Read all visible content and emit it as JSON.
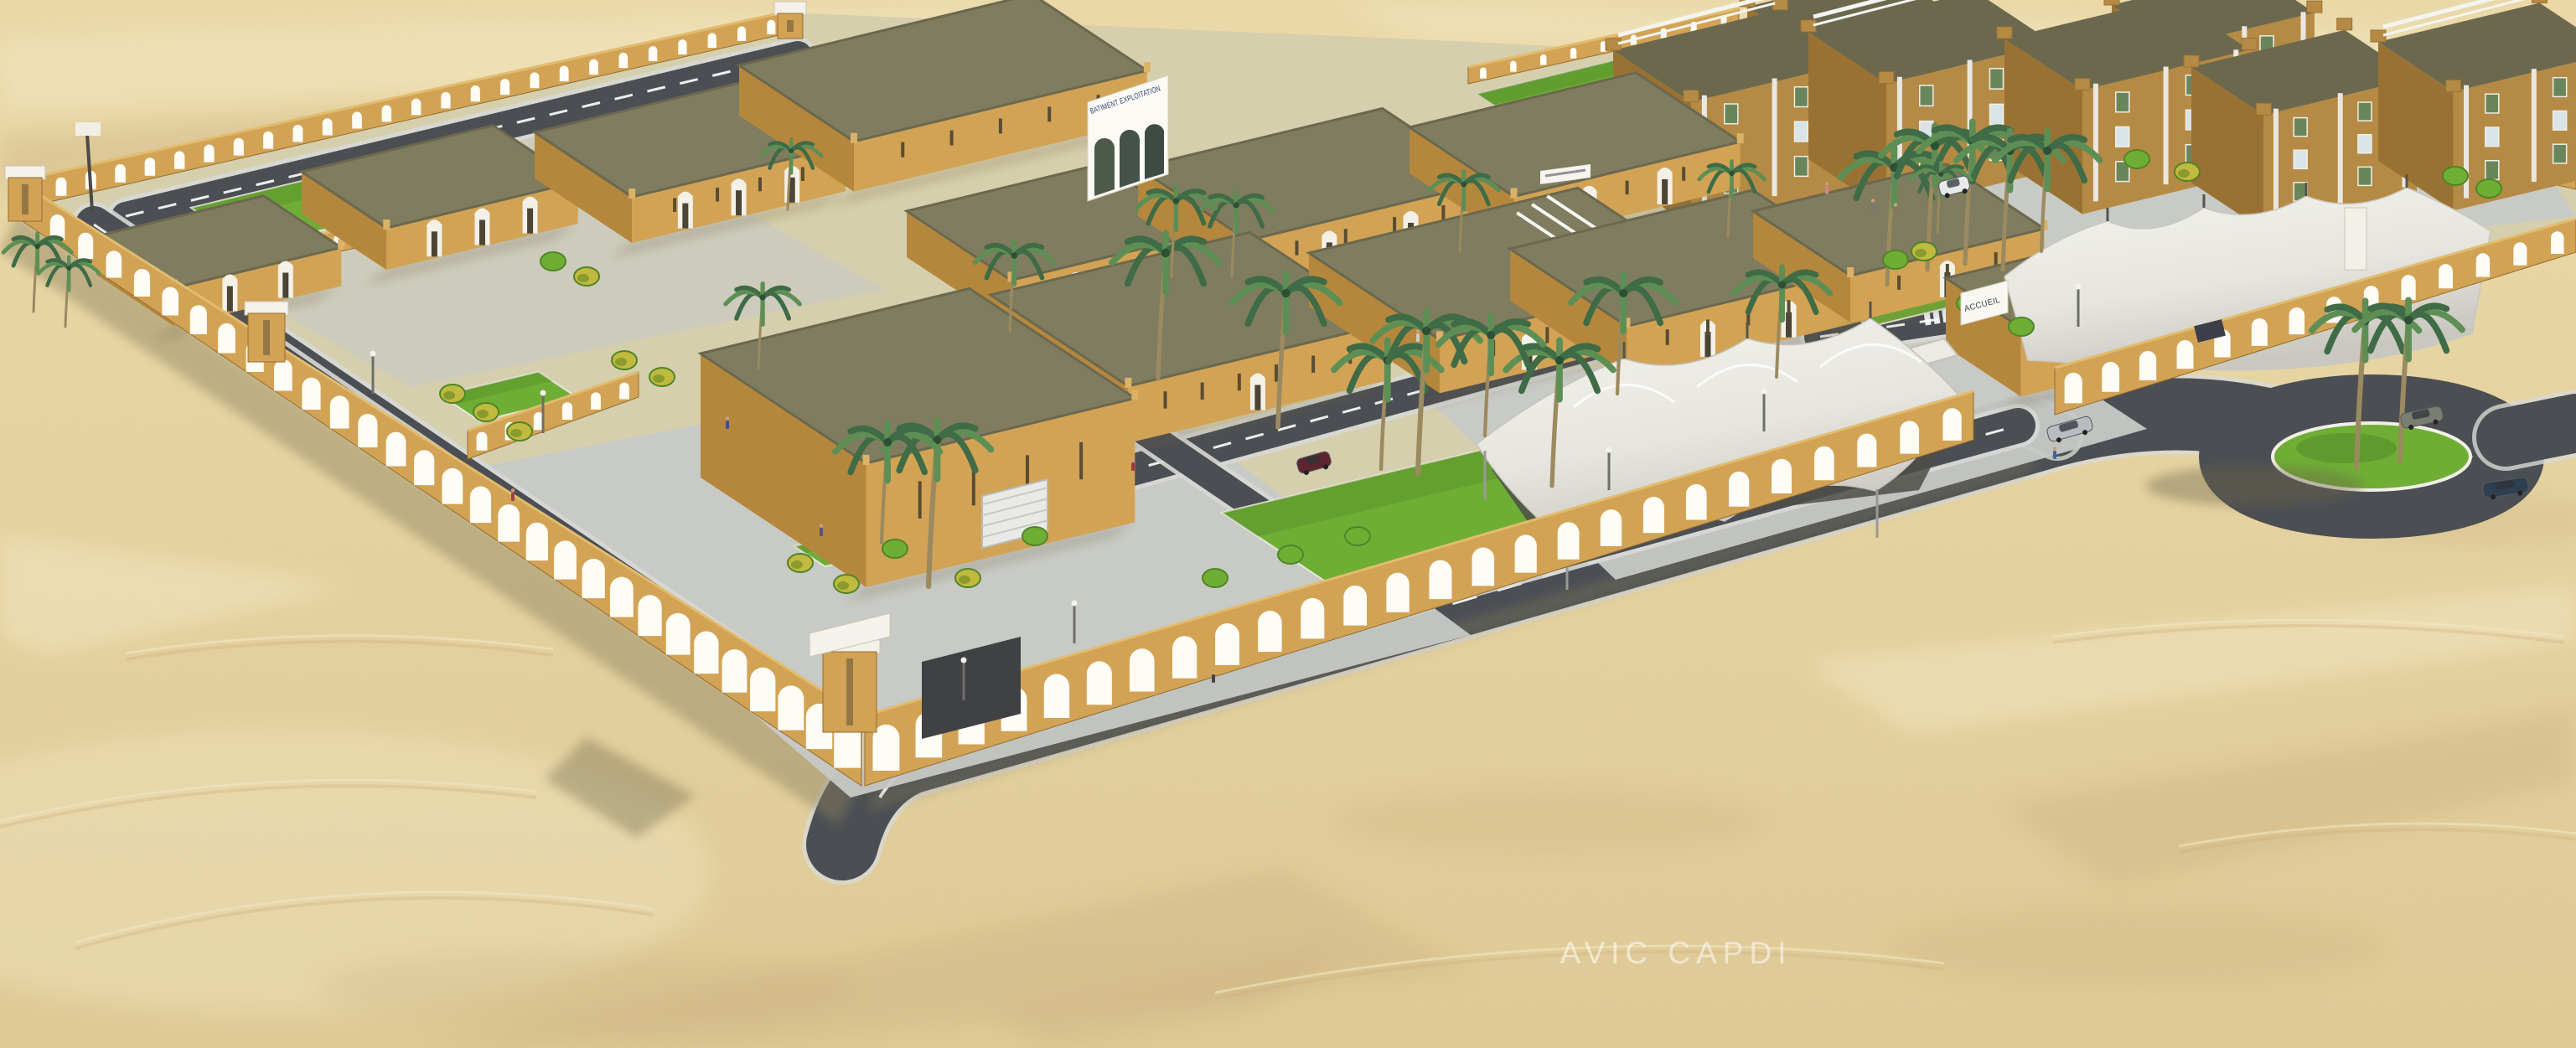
{
  "meta": {
    "alt_text": "Aerial 3D architectural rendering of a walled desert compound: arcaded perimeter walls, flat-roofed sand-colored buildings, multi-storey apartment blocks, palm trees, white tensile shade canopies, internal roads and an exterior roundabout surrounded by open sand dunes."
  },
  "labels": {
    "building_sign": "BATIMENT EXPLOITATION",
    "gate_sign": "ACCUEIL",
    "watermark": "AVIC CAPDI"
  },
  "palette": {
    "sand": "#e7d4a2",
    "sand_light": "#f4e8c3",
    "sand_shadow": "#cdb382",
    "ground": "#d6cfad",
    "paving": "#c7c9c6",
    "paving_light": "#d8d9d6",
    "road": "#4b4e53",
    "road_line": "#ffffff",
    "wall_lit": "#d2a355",
    "wall_shade": "#b5873d",
    "wall_dark": "#966d2e",
    "arch": "#fdfcf5",
    "roof": "#7f7c5f",
    "roof_dark": "#6b684e",
    "grass": "#6fae35",
    "grass_dark": "#4f8527",
    "palm_dark": "#3f6b46",
    "palm_light": "#5d8f55",
    "trunk": "#9b8a60",
    "tent": "#efeee8",
    "tent_shade": "#cfcec7",
    "tent_under": "#4e4d48",
    "white": "#ffffff",
    "sign_text": "#2a3c6e",
    "apt_lit": "#b58a44",
    "apt_shade": "#997233",
    "glass": "#d9e4e6",
    "glass_green": "#69865a",
    "flower": "#c0ba3e",
    "car_silver": "#b9bcc0",
    "car_olive": "#7a7d72",
    "car_navy": "#2e3f52",
    "car_red": "#5e2430",
    "car_dark": "#2b2e33"
  }
}
